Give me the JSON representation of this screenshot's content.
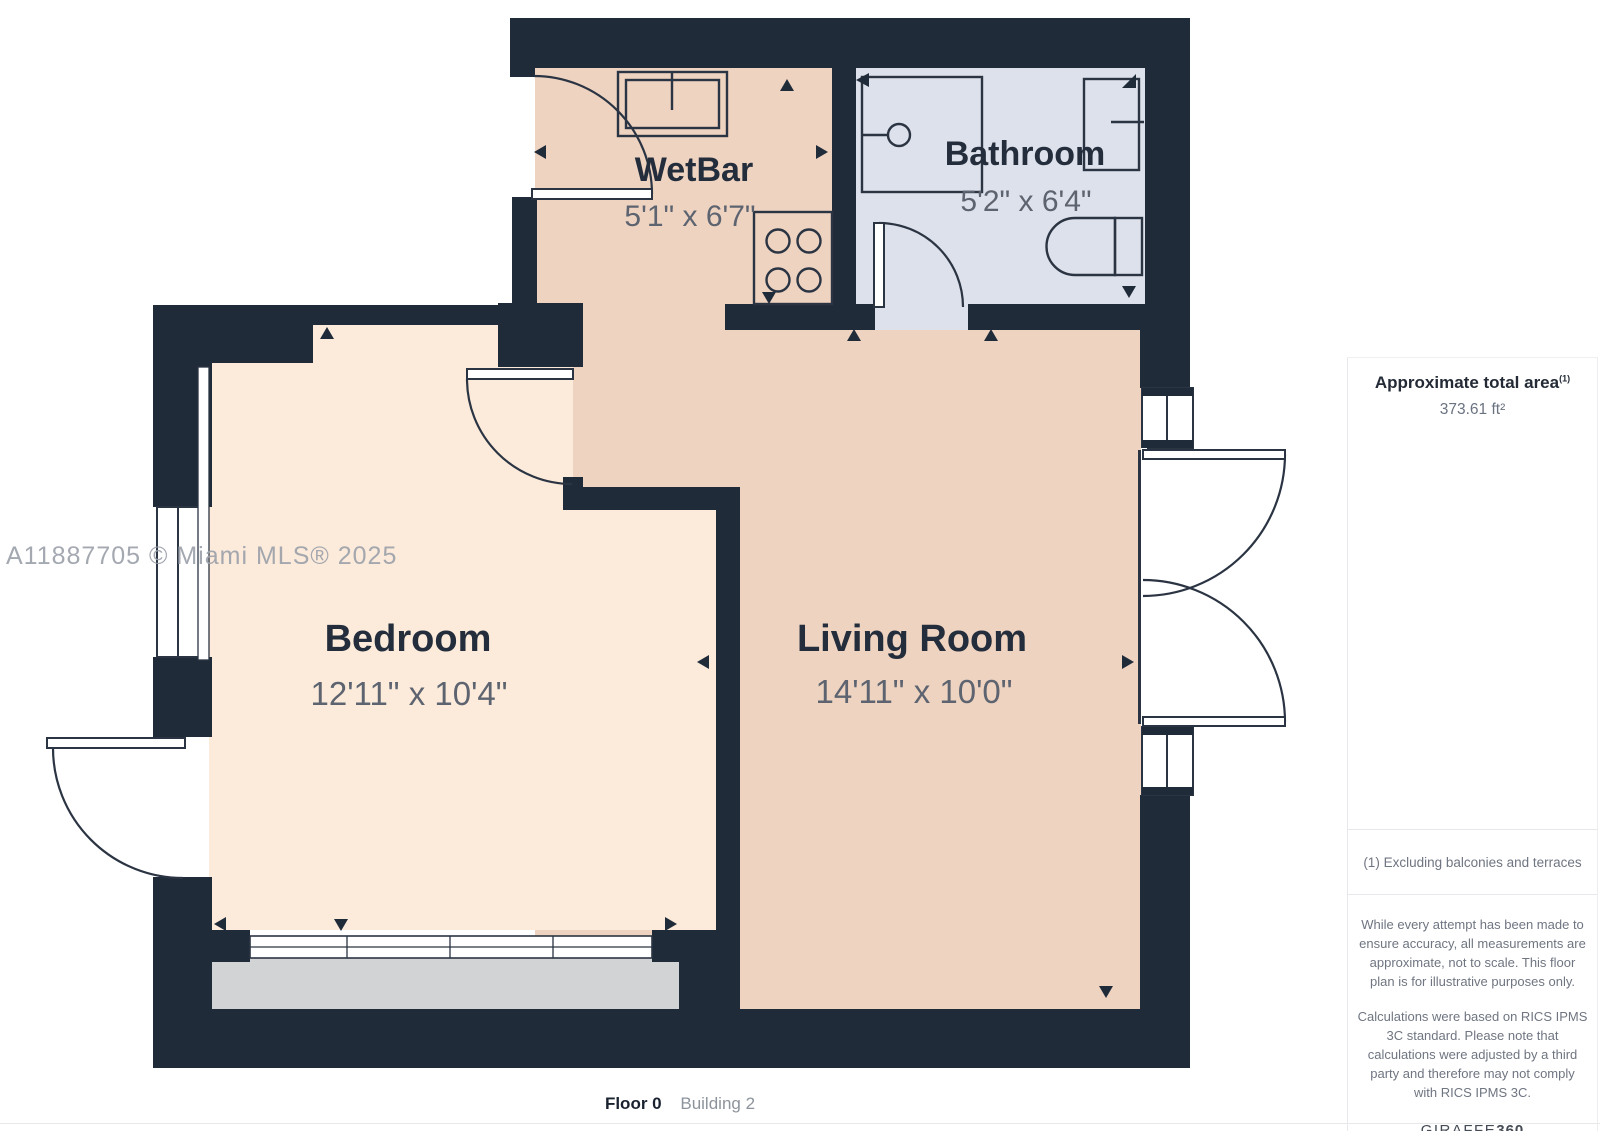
{
  "watermark": "A11887705 © Miami MLS® 2025",
  "rooms": {
    "wetbar": {
      "name": "WetBar",
      "dims": "5'1\" x 6'7\""
    },
    "bathroom": {
      "name": "Bathroom",
      "dims": "5'2\" x 6'4\""
    },
    "bedroom": {
      "name": "Bedroom",
      "dims": "12'11\" x 10'4\""
    },
    "living": {
      "name": "Living Room",
      "dims": "14'11\" x 10'0\""
    }
  },
  "sidebar": {
    "area_title": "Approximate total area",
    "area_title_sup": "(1)",
    "area_value": "373.61 ft²",
    "footnote": "(1) Excluding balconies and terraces",
    "disclaimer_1": "While every attempt has been made to ensure accuracy, all measurements are approximate, not to scale. This floor plan is for illustrative purposes only.",
    "disclaimer_2": "Calculations were based on RICS IPMS 3C standard. Please note that calculations were adjusted by a third party and therefore may not comply with RICS IPMS 3C.",
    "logo_text": "GIRAFFE",
    "logo_suffix": "360"
  },
  "footer": {
    "floor": "Floor 0",
    "building": "Building 2"
  },
  "colors": {
    "wall": "#202b3a",
    "floor_main": "#eed3c1",
    "floor_bedroom": "#fcebdb",
    "floor_bathroom": "#dde1eb",
    "floor_terrace": "#d2d3d5"
  }
}
